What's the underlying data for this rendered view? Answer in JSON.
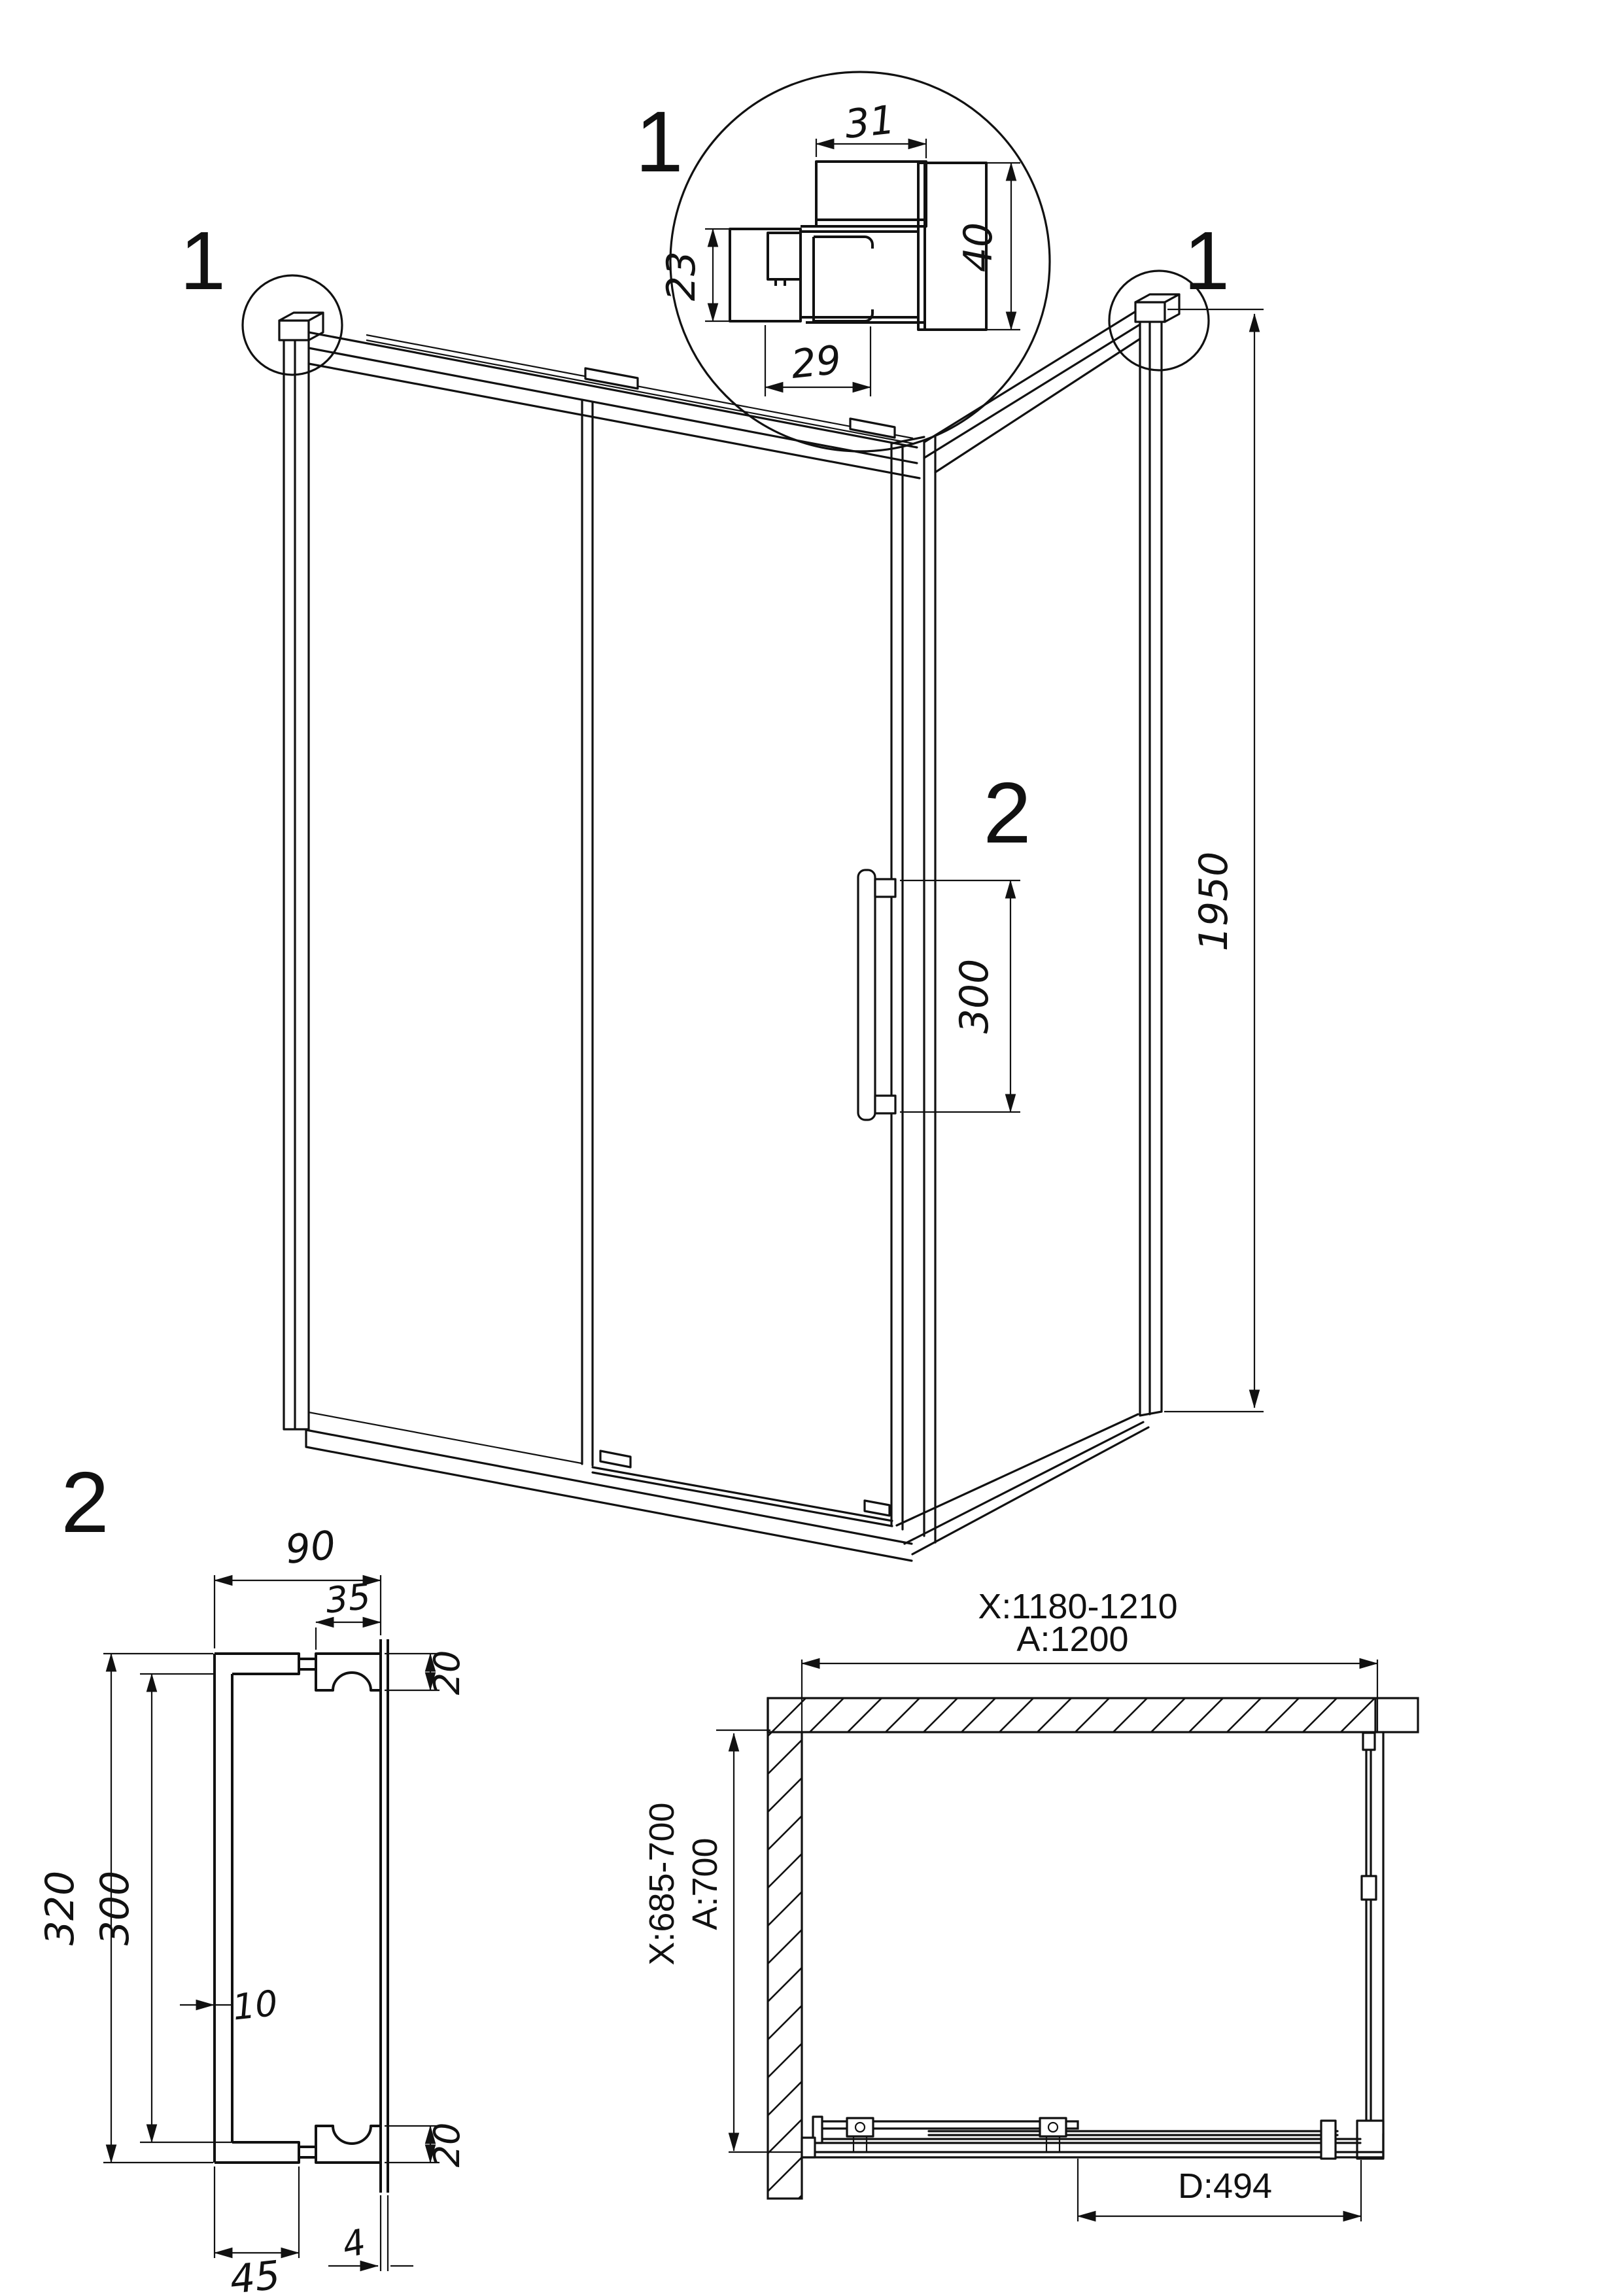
{
  "colors": {
    "line": "#111111",
    "background": "#ffffff"
  },
  "detail_top": {
    "label": "1",
    "dim_width_top": "31",
    "dim_height_right": "40",
    "dim_height_left": "23",
    "dim_width_bottom": "29"
  },
  "iso": {
    "callout_left": "1",
    "callout_right": "1",
    "handle_callout": "2",
    "dim_height": "1950",
    "dim_handle": "300"
  },
  "handle_detail": {
    "label": "2",
    "dim_depth": "90",
    "dim_mount_width": "35",
    "dim_mount_height_top": "20",
    "dim_height_overall": "320",
    "dim_height_centers": "300",
    "dim_bar": "10",
    "dim_mount_height_bottom": "20",
    "dim_glass": "4",
    "dim_arm": "45"
  },
  "plan": {
    "dim_width_range": "X:1180-1210",
    "dim_width": "A:1200",
    "dim_depth_range": "X:685-700",
    "dim_depth": "A:700",
    "dim_door": "D:494"
  }
}
